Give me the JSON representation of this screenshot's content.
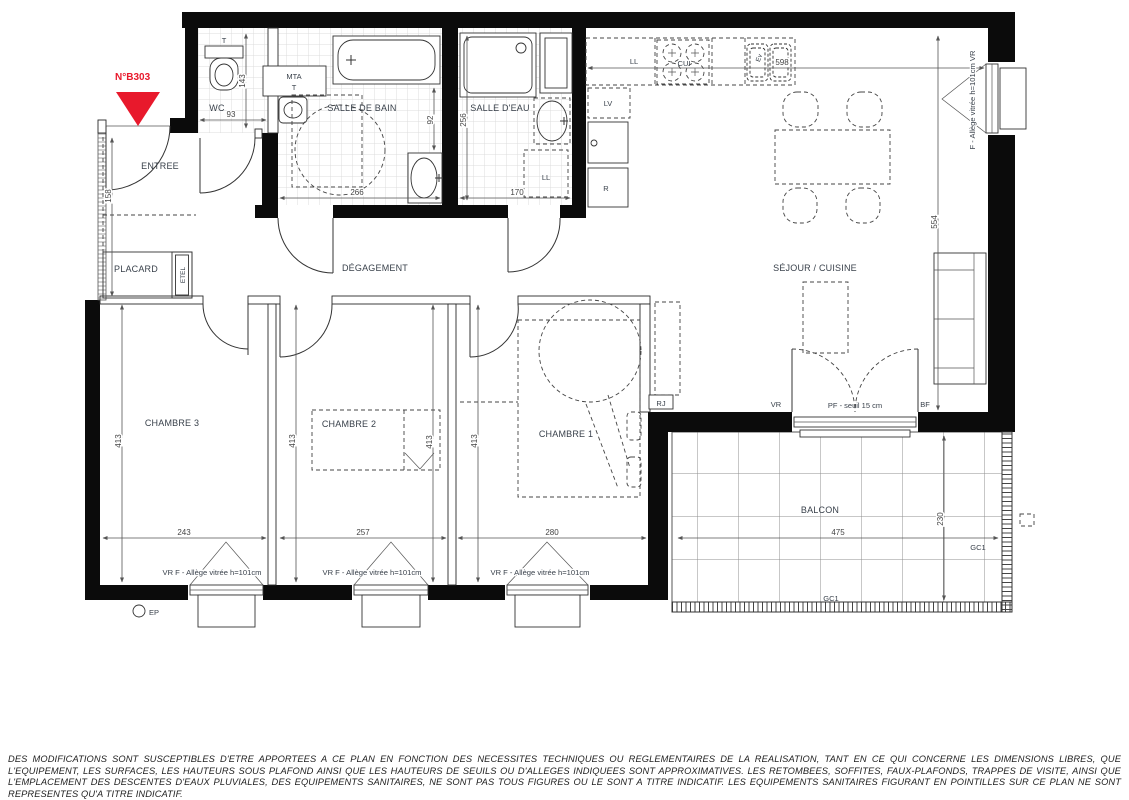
{
  "meta": {
    "plan_number": "N°B303"
  },
  "rooms": {
    "entree": "ENTREE",
    "wc": "WC",
    "salle_de_bain": "SALLE DE BAIN",
    "salle_d_eau": "SALLE D'EAU",
    "degagement": "DÉGAGEMENT",
    "placard": "PLACARD",
    "etel": "ETEL",
    "sejour_cuisine": "SÉJOUR / CUISINE",
    "chambre1": "CHAMBRE 1",
    "chambre2": "CHAMBRE 2",
    "chambre3": "CHAMBRE 3",
    "balcon": "BALCON"
  },
  "equipment": {
    "wc_tank": "T",
    "mta": "MTA",
    "mta_t": "T",
    "washer_sde": "LL",
    "washer_kitchen": "LL",
    "hob": "CUI",
    "sink_kitchen": "Ev",
    "dishwasher": "LV",
    "fridge": "R",
    "rj": "RJ",
    "ep": "EP",
    "gc1_right": "GC1",
    "gc1_bottom": "GC1"
  },
  "openings": {
    "vr": "VR",
    "bf": "BF",
    "pf": "PF - seuil 15 cm",
    "window_ch3": "VR F - Allège vitrée h=101cm",
    "window_ch2": "VR F - Allège vitrée h=101cm",
    "window_ch1": "VR F - Allège vitrée h=101cm",
    "window_sejour": "F - Allège vitrée h=101cm  VR"
  },
  "dimensions": {
    "wc_w": "93",
    "wc_h": "143",
    "entree_h": "158",
    "sdb_w": "266",
    "sdb_h": "92",
    "sde_w": "170",
    "sde_h": "256",
    "kitchen_w": "598",
    "sejour_h": "554",
    "ch3_w": "243",
    "ch3_h": "413",
    "ch2_w": "257",
    "ch2_h_left": "413",
    "ch2_h_right": "413",
    "ch1_w": "280",
    "ch1_h": "413",
    "balcon_w": "475",
    "balcon_d": "230"
  },
  "disclaimer": "DES MODIFICATIONS SONT SUSCEPTIBLES D'ETRE APPORTEES A CE PLAN EN FONCTION DES NECESSITES TECHNIQUES OU REGLEMENTAIRES DE LA REALISATION, TANT EN CE QUI CONCERNE LES DIMENSIONS LIBRES, QUE L'EQUIPEMENT, LES SURFACES, LES HAUTEURS SOUS PLAFOND AINSI QUE LES HAUTEURS DE SEUILS OU D'ALLEGES INDIQUEES SONT APPROXIMATIVES. LES RETOMBEES, SOFFITES, FAUX-PLAFONDS, TRAPPES DE VISITE, AINSI QUE L'EMPLACEMENT DES DESCENTES D'EAUX PLUVIALES, DES EQUIPEMENTS SANITAIRES, NE SONT PAS TOUS FIGURES OU LE SONT A TITRE INDICATIF. LES EQUIPEMENTS SANITAIRES FIGURANT EN POINTILLES SUR CE PLAN NE SONT REPRESENTES QU'A TITRE INDICATIF."
}
